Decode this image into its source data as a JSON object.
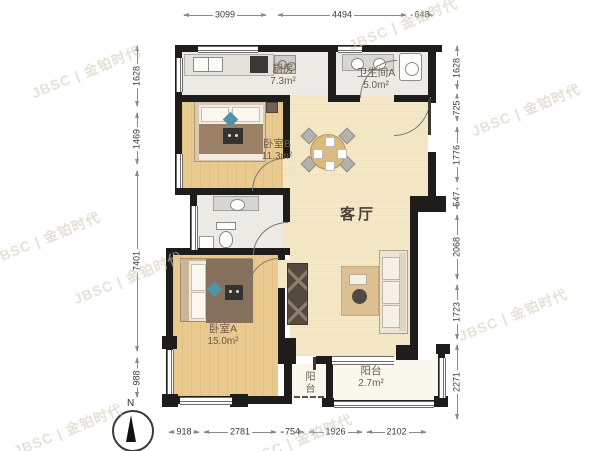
{
  "watermark": {
    "text": "JBSC | 金铂时代"
  },
  "compass": {
    "label": "N"
  },
  "rooms": {
    "kitchen": {
      "name": "厨房",
      "area": "7.3m²"
    },
    "bathroom_a": {
      "name": "卫生间A",
      "area": "5.0m²"
    },
    "bedroom_b": {
      "name": "卧室B",
      "area": "11.3m²"
    },
    "living_room": {
      "name": "客厅"
    },
    "bedroom_a": {
      "name": "卧室A",
      "area": "15.0m²"
    },
    "balcony": {
      "name": "阳台",
      "area": "2.7m²"
    },
    "balcony_small": {
      "name": "阳台"
    }
  },
  "dimensions": {
    "top": [
      "3099",
      "4494",
      "648"
    ],
    "left": [
      "1628",
      "1469",
      "7401",
      "988"
    ],
    "right": [
      "1628",
      "725",
      "1776",
      "547",
      "2068",
      "1723",
      "2271"
    ],
    "bottom": [
      "918",
      "2781",
      "754",
      "1926",
      "2102"
    ]
  },
  "colors": {
    "wall": "#1f1d1b",
    "wood_floor": "#eac98e",
    "tile_floor": "#eceae5",
    "living_floor": "#f4e7c6",
    "balcony_floor": "#faf7ef",
    "accent_blue": "#4f93a8",
    "label_text": "#6b5b49",
    "dimension_text": "#3a3a3a",
    "watermark_text": "#d3c9b8"
  }
}
